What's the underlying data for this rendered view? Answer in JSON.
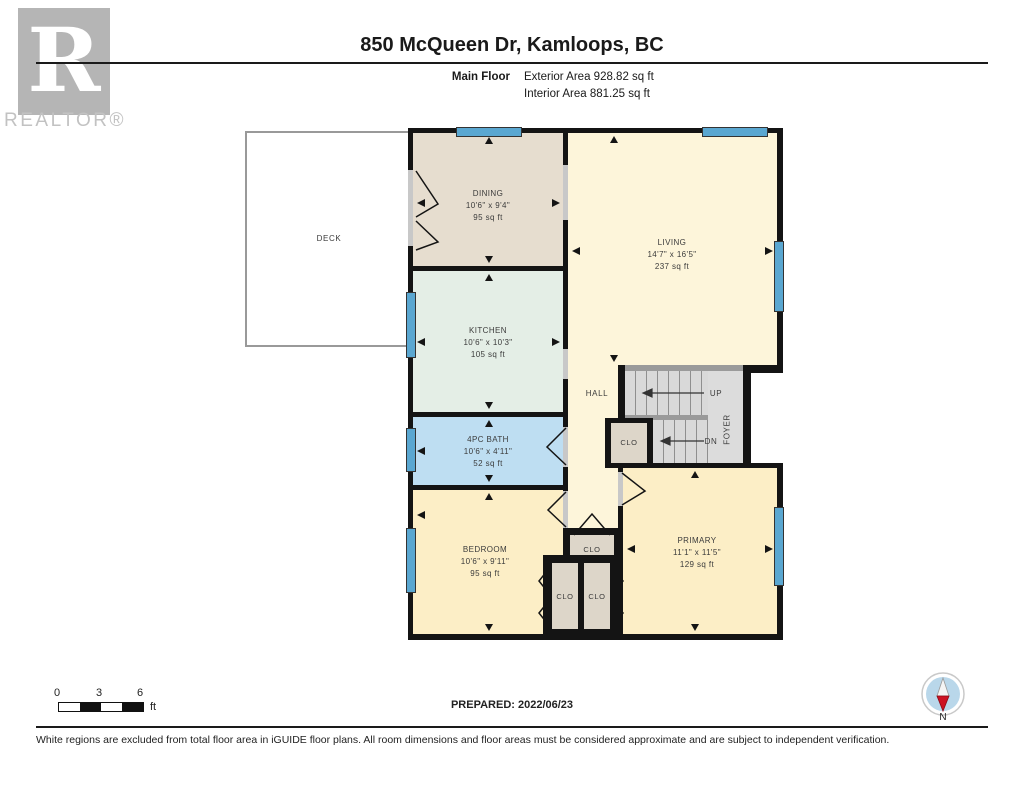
{
  "header": {
    "logo_letter": "R",
    "logo_wordmark": "REALTOR®",
    "title": "850 McQueen Dr, Kamloops, BC",
    "floor_label": "Main Floor",
    "exterior_area": "Exterior Area 928.82 sq ft",
    "interior_area": "Interior Area 881.25 sq ft"
  },
  "plan": {
    "rooms": [
      {
        "name": "DINING",
        "dims": "10'6\" x 9'4\"",
        "area": "95 sq ft"
      },
      {
        "name": "KITCHEN",
        "dims": "10'6\" x 10'3\"",
        "area": "105 sq ft"
      },
      {
        "name": "4PC BATH",
        "dims": "10'6\" x 4'11\"",
        "area": "52 sq ft"
      },
      {
        "name": "BEDROOM",
        "dims": "10'6\" x 9'11\"",
        "area": "95 sq ft"
      },
      {
        "name": "LIVING",
        "dims": "14'7\" x 16'5\"",
        "area": "237 sq ft"
      },
      {
        "name": "PRIMARY",
        "dims": "11'1\" x 11'5\"",
        "area": "129 sq ft"
      }
    ],
    "areas": {
      "deck": "DECK",
      "hall": "HALL",
      "foyer": "FOYER",
      "up": "UP",
      "dn": "DN",
      "closet": "CLO"
    },
    "colors": {
      "wall": "#141414",
      "dining": "#e6ddcf",
      "kitchen": "#e4eee6",
      "bath": "#bedef2",
      "bedroom": "#fceec6",
      "living": "#fdf5da",
      "closet": "#ddd6c9",
      "stairs": "#dcdcdc",
      "window": "#5aa7d1",
      "compass_red": "#cc1122"
    }
  },
  "footer": {
    "scale": {
      "t0": "0",
      "t3": "3",
      "t6": "6",
      "unit": "ft"
    },
    "prepared": "PREPARED: 2022/06/23",
    "compass_label": "N",
    "disclaimer": "White regions are excluded from total floor area in iGUIDE floor plans. All room dimensions and floor areas must be considered approximate and are subject to independent verification."
  }
}
